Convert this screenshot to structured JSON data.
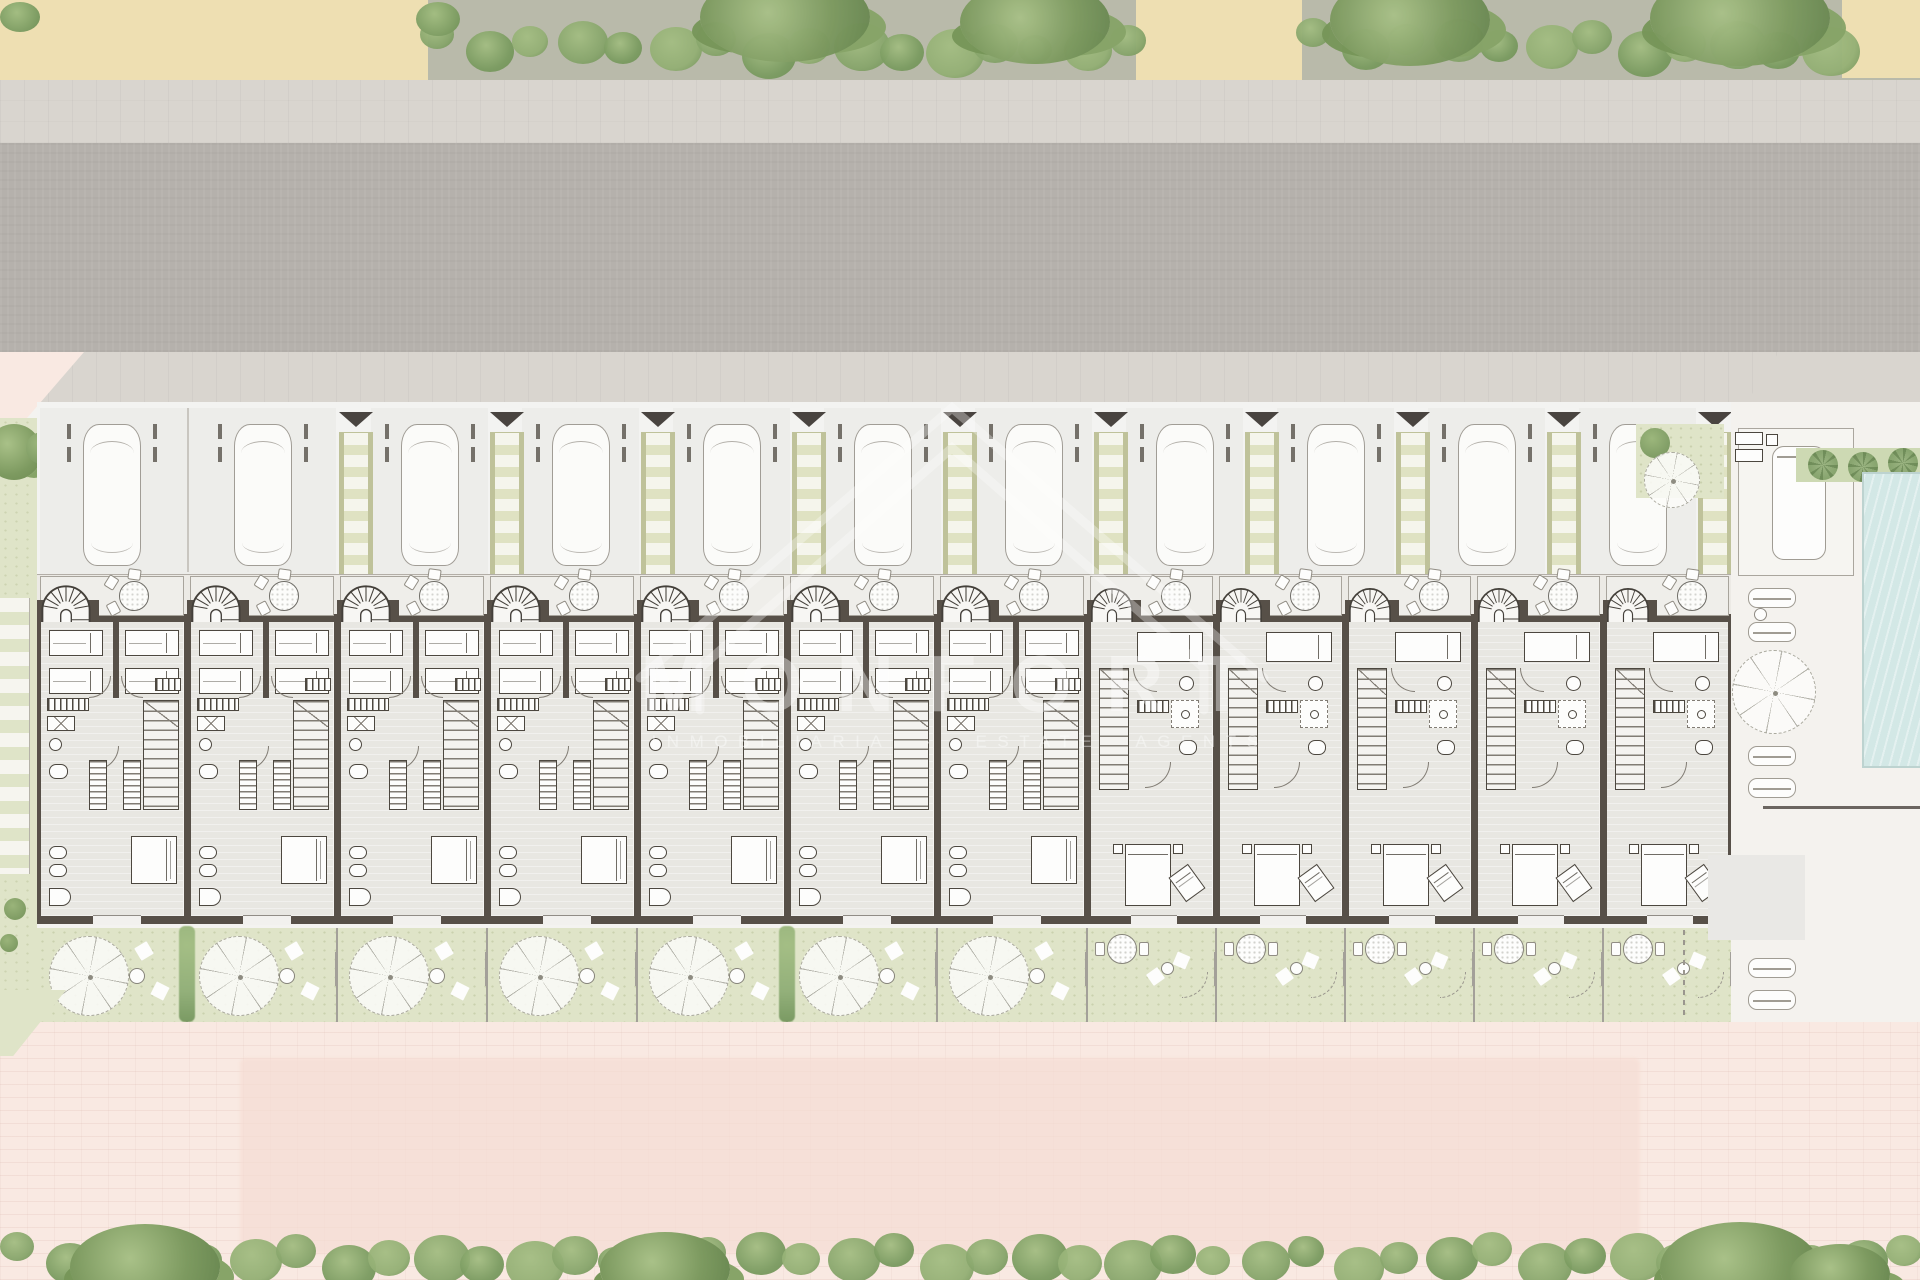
{
  "watermark": {
    "brand_text": "MONFORT",
    "tagline_text": "INMOBILIARIA · ESTATE AGENTS",
    "logo": "house-outline-icon",
    "color": "#ffffff"
  },
  "site": {
    "unit_count_total": 12,
    "unit_count_type_a": 7,
    "unit_count_type_b": 5,
    "parking_spaces": 11,
    "pedestrian_walkways": 10,
    "entry_markers": 10,
    "private_gardens": 12,
    "terrace_tables": 12,
    "pool": true,
    "pool_side_loungers": 5
  },
  "colors": {
    "topGround": "#b9baaa",
    "sand": "#eedfb2",
    "bushGreen": "#87a56b",
    "bushLight": "#a3bd82",
    "bushDark": "#6d8e55",
    "sidewalk": "#d9d5cf",
    "road": "#b5b1ac",
    "parkingBg": "#f3f3f1",
    "bayShade": "#ededea",
    "carFill": "#fbfbf9",
    "carLine": "#a19d96",
    "ladderBg": "#dfe2c2",
    "ladderRung": "#f5f5ec",
    "ladderRail": "#bfc29a",
    "marker": "#494440",
    "terrace": "#eceae5",
    "wall": "#575048",
    "floor": "#e8e7e2",
    "furnFill": "#fdfdfc",
    "furnLine": "#4c473f",
    "stripe": "#817c74",
    "lawn": "#dfe4c8",
    "hedgeDivider": "#93b07a",
    "fence": "#a3a099",
    "pavement": "#f9e9e2",
    "pavementDeep": "#f6ddd4",
    "brickLine": "rgba(205,160,148,0.16)",
    "poolDeck": "#f4f2ee",
    "palmBand": "#cdd9b3",
    "pool": "#d3e8e6",
    "watermark": "#ffffff"
  }
}
